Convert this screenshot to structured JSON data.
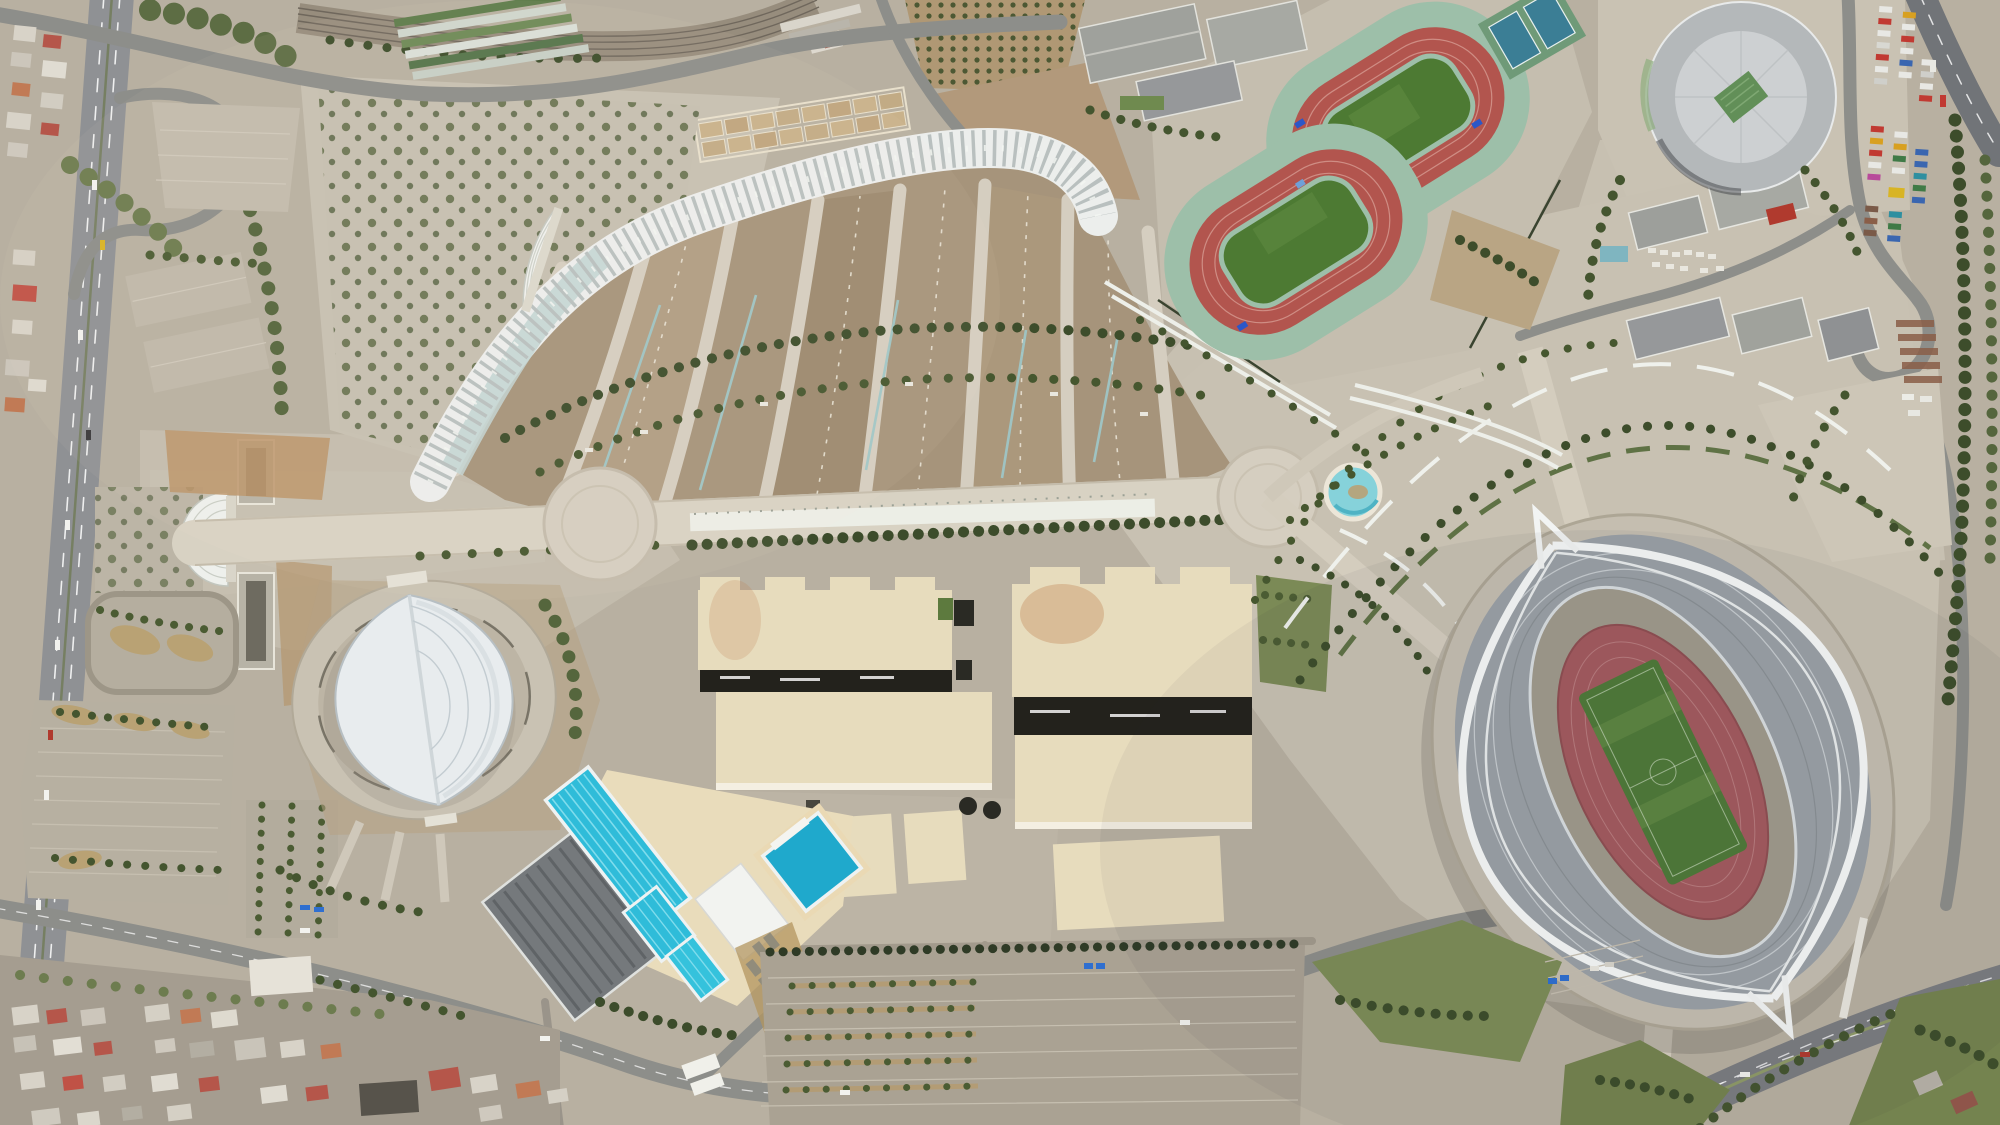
{
  "scene": {
    "kind": "aerial-orthophoto of an olympic sports complex",
    "features": {
      "stadium": {
        "label": "large oval stadium with twin white arches, gray roof crescents, mauve running track and green football pitch"
      },
      "velodrome": {
        "label": "hall with white leaf-shaped roof set in a circular concourse ring"
      },
      "circular_hall": {
        "label": "large circular gray-roofed indoor arena with green skylight"
      },
      "track_upper": {
        "label": "red athletics training track with green infield, rotated, mint apron"
      },
      "track_lower": {
        "label": "second red athletics training track with green infield"
      },
      "tennis_courts": {
        "label": "two blue-green tennis courts"
      },
      "colonnade": {
        "label": "long white ribbed colonnade arcing over the fan esplanade"
      },
      "fan_esplanade": {
        "label": "fan of tan wedge plots separated by radiating concrete spokes with tree arcs and pale blue drainage lines"
      },
      "amphitheater_shell": {
        "label": "small white ribbed fan-shaped shell structure"
      },
      "promenade": {
        "label": "wide pedestrian promenade with two circular plaza nodes"
      },
      "west_entrance_canopy": {
        "label": "white ribbed fan canopy at west entrance"
      },
      "fountain": {
        "label": "circular fountain pool with turquoise water"
      },
      "beige_halls": {
        "label": "cluster of large cream flat-roofed exhibition halls with dark shadow gaps"
      },
      "pools": {
        "label": "outdoor aquatic centre: two cyan lane pools, small training pool and octagonal diving pool on cream deck"
      },
      "indoor_pool_hall": {
        "label": "dark gray ribbed roof of indoor pool building"
      },
      "esplanade_arcs": {
        "label": "concentric arcs of hedges, benches and trees around the stadium"
      },
      "railway": {
        "label": "railway corridor with station platforms and red-accented station building"
      },
      "greenhouses": {
        "label": "rows of long green and white greenhouse roofs"
      },
      "orchard": {
        "label": "olive orchard planted in a tight grid"
      },
      "garden_plots": {
        "label": "rectangular nursery garden plots"
      },
      "tree_plaza": {
        "label": "paved plaza planted with a grid of small trees"
      },
      "truck_depot": {
        "label": "roadside depot with rows of colorful trucks and buses"
      },
      "highway_west": {
        "label": "multi-lane highway with dashed lane markings"
      },
      "boulevard_south": {
        "label": "curving southern boulevard"
      },
      "avenue_southeast": {
        "label": "wide southeast avenue with median"
      },
      "residential_sw": {
        "label": "dense low-rise residential blocks with white, gray and red roofs"
      },
      "residential_nw": {
        "label": "small residential cluster with red and white roofs"
      },
      "parking_sw": {
        "label": "large striped parking lot with teardrop tree islands"
      },
      "parking_south": {
        "label": "huge parking field with tree-lined rows"
      },
      "service_buildings": {
        "label": "gray gable-roofed service buildings with car park"
      },
      "loop_ramp": {
        "label": "looping highway access ramp"
      }
    }
  },
  "palette": {
    "pavement": "#c6bfb0",
    "pavement_dark": "#b3ab9c",
    "dirt": "#a8947a",
    "dirt_orange": "#bb9468",
    "track_red": "#b2554e",
    "grass": "#4d7a33",
    "lawn": "#74834f",
    "pool_cyan": "#2fbcd9",
    "fountain_water": "#86d2da",
    "roof_beige": "#e7dcbd",
    "roof_gray": "#9aa1a6",
    "structure_white": "#f2f4f1",
    "road": "#8d8e8a",
    "tree_dark": "#3d4d2b",
    "shadow": "#23221c",
    "mint_apron": "#9dbfa9",
    "court_blue": "#3b7e95"
  }
}
